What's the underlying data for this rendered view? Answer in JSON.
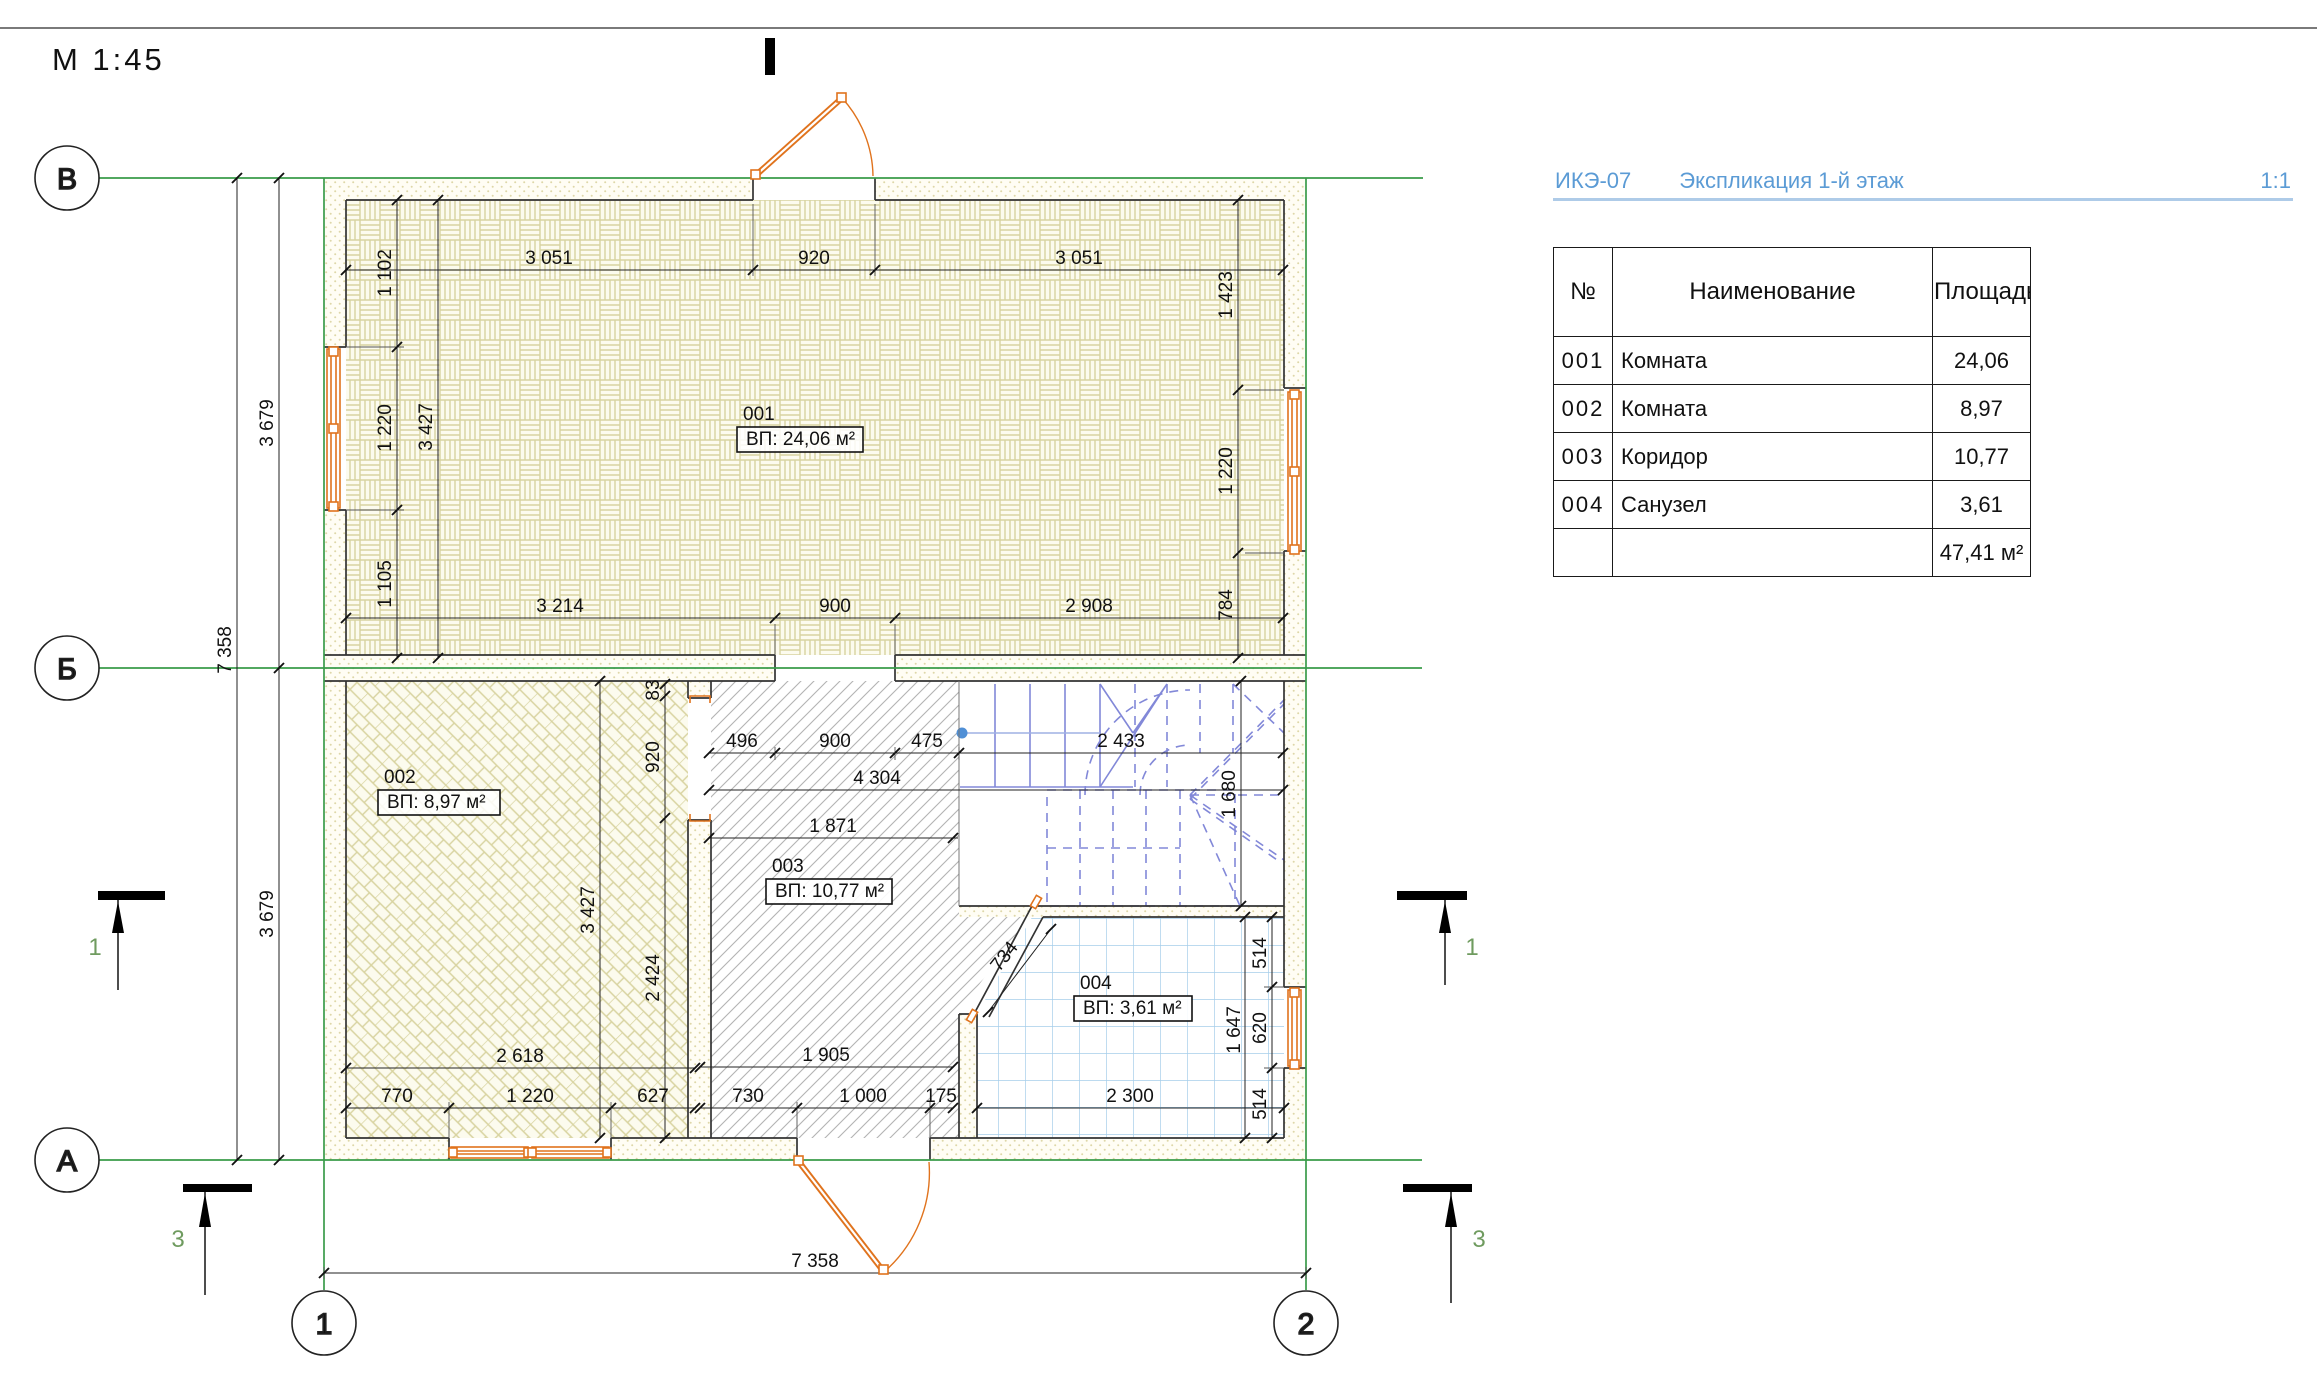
{
  "page": {
    "scale_label": "М 1:45"
  },
  "plan": {
    "axes": [
      {
        "label": "В"
      },
      {
        "label": "Б"
      },
      {
        "label": "А"
      },
      {
        "label": "1"
      },
      {
        "label": "2"
      }
    ],
    "rooms": [
      {
        "number": "001",
        "area": "ВП: 24,06 м²"
      },
      {
        "number": "002",
        "area": "ВП: 8,97 м²"
      },
      {
        "number": "003",
        "area": "ВП: 10,77 м²"
      },
      {
        "number": "004",
        "area": "ВП: 3,61 м²"
      }
    ],
    "sections": [
      {
        "label": "1"
      },
      {
        "label": "1"
      },
      {
        "label": "3"
      },
      {
        "label": "3"
      }
    ],
    "dimensions": [
      {
        "text": "3 051",
        "x": 549,
        "y": 264
      },
      {
        "text": "920",
        "x": 814,
        "y": 264
      },
      {
        "text": "3 051",
        "x": 1079,
        "y": 264
      },
      {
        "text": "3 214",
        "x": 560,
        "y": 612
      },
      {
        "text": "900",
        "x": 835,
        "y": 612
      },
      {
        "text": "2 908",
        "x": 1089,
        "y": 612
      },
      {
        "text": "1 102",
        "x": 391,
        "y": 273,
        "rot": -90
      },
      {
        "text": "1 220",
        "x": 391,
        "y": 428,
        "rot": -90
      },
      {
        "text": "1 105",
        "x": 391,
        "y": 584,
        "rot": -90
      },
      {
        "text": "3 427",
        "x": 432,
        "y": 427,
        "rot": -90
      },
      {
        "text": "1 423",
        "x": 1232,
        "y": 295,
        "rot": -90
      },
      {
        "text": "1 220",
        "x": 1232,
        "y": 471,
        "rot": -90
      },
      {
        "text": "784",
        "x": 1232,
        "y": 605,
        "rot": -90
      },
      {
        "text": "3 679",
        "x": 273,
        "y": 423,
        "rot": -90
      },
      {
        "text": "3 679",
        "x": 273,
        "y": 914,
        "rot": -90
      },
      {
        "text": "7 358",
        "x": 231,
        "y": 650,
        "rot": -90
      },
      {
        "text": "7 358",
        "x": 815,
        "y": 1267
      },
      {
        "text": "496",
        "x": 742,
        "y": 747
      },
      {
        "text": "900",
        "x": 835,
        "y": 747
      },
      {
        "text": "475",
        "x": 927,
        "y": 747
      },
      {
        "text": "2 433",
        "x": 1121,
        "y": 747
      },
      {
        "text": "4 304",
        "x": 877,
        "y": 784
      },
      {
        "text": "1 871",
        "x": 833,
        "y": 832
      },
      {
        "text": "1 680",
        "x": 1235,
        "y": 794,
        "rot": -90
      },
      {
        "text": "83",
        "x": 659,
        "y": 690,
        "rot": -90
      },
      {
        "text": "920",
        "x": 659,
        "y": 757,
        "rot": -90
      },
      {
        "text": "2 424",
        "x": 659,
        "y": 978,
        "rot": -90
      },
      {
        "text": "3 427",
        "x": 594,
        "y": 910,
        "rot": -90
      },
      {
        "text": "2 618",
        "x": 520,
        "y": 1062
      },
      {
        "text": "770",
        "x": 397,
        "y": 1102
      },
      {
        "text": "1 220",
        "x": 530,
        "y": 1102
      },
      {
        "text": "627",
        "x": 653,
        "y": 1102
      },
      {
        "text": "1 905",
        "x": 826,
        "y": 1061
      },
      {
        "text": "730",
        "x": 748,
        "y": 1102
      },
      {
        "text": "1 000",
        "x": 863,
        "y": 1102
      },
      {
        "text": "175",
        "x": 941,
        "y": 1102
      },
      {
        "text": "734",
        "x": 1009,
        "y": 960,
        "rot": -52
      },
      {
        "text": "2 300",
        "x": 1130,
        "y": 1102
      },
      {
        "text": "1 647",
        "x": 1240,
        "y": 1030,
        "rot": -90
      },
      {
        "text": "514",
        "x": 1266,
        "y": 953,
        "rot": -90
      },
      {
        "text": "620",
        "x": 1266,
        "y": 1028,
        "rot": -90
      },
      {
        "text": "514",
        "x": 1266,
        "y": 1104,
        "rot": -90
      }
    ]
  },
  "spec": {
    "code": "ИКЭ-07",
    "title": "Экспликация 1-й этаж",
    "sheet_scale": "1:1",
    "columns": [
      "№",
      "Наименование",
      "Площадь"
    ],
    "rows": [
      [
        "001",
        "Комната",
        "24,06"
      ],
      [
        "002",
        "Комната",
        "8,97"
      ],
      [
        "003",
        "Коридор",
        "10,77"
      ],
      [
        "004",
        "Санузел",
        "3,61"
      ]
    ],
    "total": "47,41 м²"
  },
  "colors": {
    "axis_green": "#3a9b4a",
    "joinery_orange": "#e0731d",
    "stair_blue": "#8288d8",
    "stair_dot_blue": "#4f8fd6",
    "hatch_olive": "#d8d3a0",
    "tile_blue": "#a6cdea",
    "corridor_gray": "#b3b3b3",
    "spec_blue": "#5b9bd5",
    "spec_underline": "#aecbe8",
    "section_green": "#6f9b5f"
  }
}
